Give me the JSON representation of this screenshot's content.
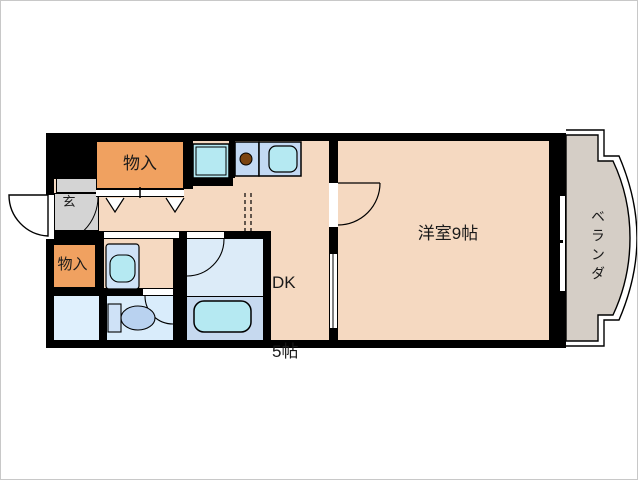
{
  "floorplan": {
    "title": "1DK apartment floor plan",
    "rooms": {
      "western_room": {
        "label": "洋室9帖"
      },
      "dining_kitchen": {
        "line1": "DK",
        "line2": "5帖"
      },
      "veranda": {
        "label": "ベランダ"
      },
      "entrance": {
        "label": "玄"
      },
      "storage_top": {
        "label": "物入"
      },
      "storage_left": {
        "label": "物入"
      }
    },
    "fixtures": [
      "bathtub-icon",
      "toilet-icon",
      "washbasin-icon",
      "kitchen-sink-icon",
      "stove-burner-icon",
      "washer-pan-icon",
      "door-swing-arc",
      "folding-door-mark",
      "window-symbol"
    ],
    "colors": {
      "room_floor": "#f5d9c1",
      "storage_orange": "#f0a160",
      "entrance_gray": "#d4d4d4",
      "veranda_gray": "#d5cec6",
      "bath_floor": "#dcebf8",
      "bath_lower": "#c6d9ef",
      "fixture_cyan": "#b5e9f2",
      "counter_blue": "#c3d9f3",
      "toilet_floor": "#d9ecfb",
      "laundry_floor": "#dff0fd",
      "fixture_blue": "#cfe2f7",
      "toilet_bowl": "#b9d2f0",
      "stove_brown": "#7b4411",
      "wall": "#000000"
    }
  }
}
